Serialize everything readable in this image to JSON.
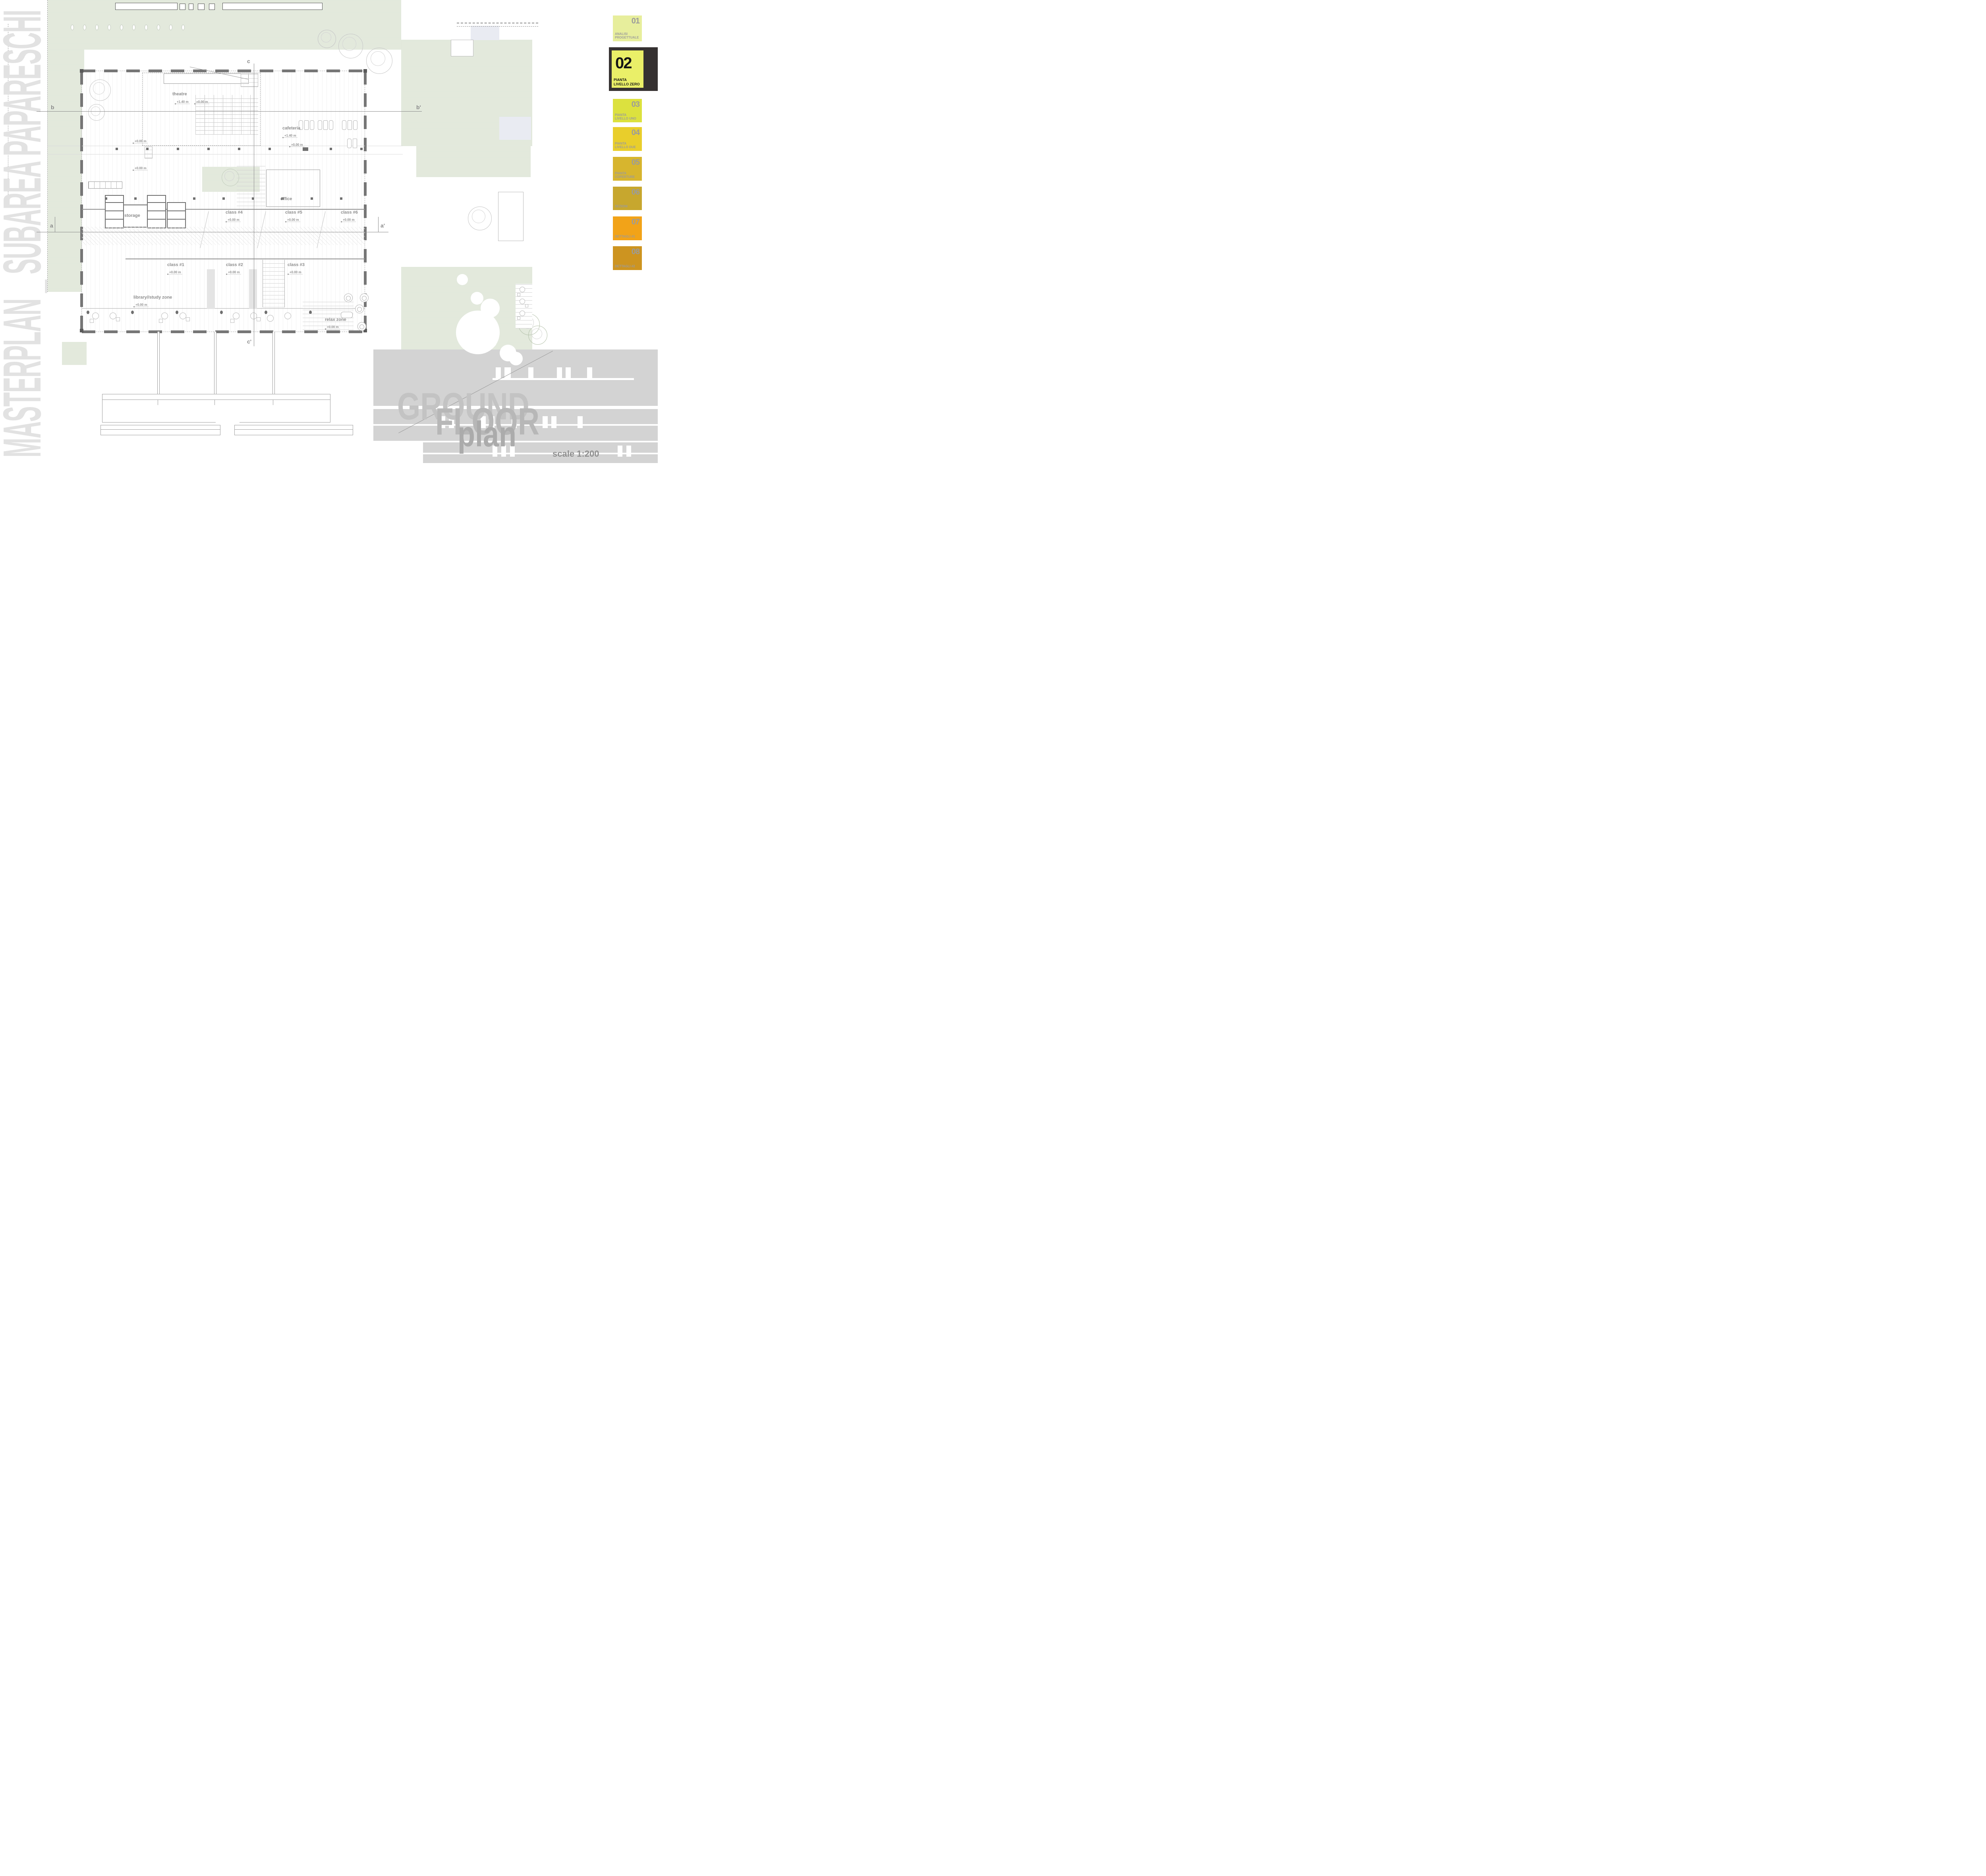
{
  "masthead": {
    "vertical_title": "MASTERPLAN _ SUBAREA PAPARESCHI"
  },
  "title_block": {
    "line1": "GROUND",
    "line2": "FLOOR",
    "line3": "plan",
    "scale_label": "scale 1:200",
    "band_color": "#d3d3d3",
    "text_color": "#bdbdbd"
  },
  "sidebar": {
    "tabs": [
      {
        "number": "01",
        "label": "ANALISI PROGETTUALE",
        "color": "#e7ee9c",
        "active": false
      },
      {
        "number": "02",
        "label": "PIANTA LIVELLO ZERO",
        "color": "#eaef68",
        "frame_color": "#353131",
        "active": true
      },
      {
        "number": "03",
        "label": "PIANTA LIVELLO UNO",
        "color": "#dce13e",
        "active": false
      },
      {
        "number": "04",
        "label": "PIANTA LIVELLO DUE",
        "color": "#e9ce2b",
        "active": false
      },
      {
        "number": "05",
        "label": "PIANTA COPERTURE",
        "color": "#d7b52e",
        "active": false
      },
      {
        "number": "06",
        "label": "SEZIONI",
        "color": "#c7a72e",
        "active": false
      },
      {
        "number": "07",
        "label": "DETTAGLI #1",
        "color": "#f2a318",
        "active": false
      },
      {
        "number": "08",
        "label": "DETTAGLI #2",
        "color": "#cd9420",
        "active": false
      }
    ]
  },
  "plan": {
    "lawn_color": "#e4eade",
    "rooms": {
      "theatre": {
        "name": "theatre",
        "level_a": "+1.40 m",
        "level_b": "+0.00 m"
      },
      "cafeteria": {
        "name": "cafeteria",
        "level": "+1.40 m"
      },
      "office": {
        "name": "office"
      },
      "storage": {
        "name": "storage"
      },
      "class4": {
        "name": "class #4",
        "level": "+0.00 m"
      },
      "class5": {
        "name": "class #5",
        "level": "+0.00 m"
      },
      "class6": {
        "name": "class #6",
        "level": "+0.00 m"
      },
      "class1": {
        "name": "class #1",
        "level": "+0.00 m"
      },
      "class2": {
        "name": "class #2",
        "level": "+0.00 m"
      },
      "class3": {
        "name": "class #3",
        "level": "+0.00 m"
      },
      "library": {
        "name": "library//study zone",
        "level": "+0.00 m"
      },
      "relax": {
        "name": "relax zone",
        "level": "+0.00 m"
      }
    },
    "floating_levels": {
      "f1": "+0.00 m",
      "f2": "+0.00 m",
      "f3": "+0.00 m"
    },
    "section_markers": {
      "a": "a",
      "a2": "a'",
      "b": "b",
      "b2": "b'",
      "c": "c",
      "c2": "c'"
    }
  }
}
